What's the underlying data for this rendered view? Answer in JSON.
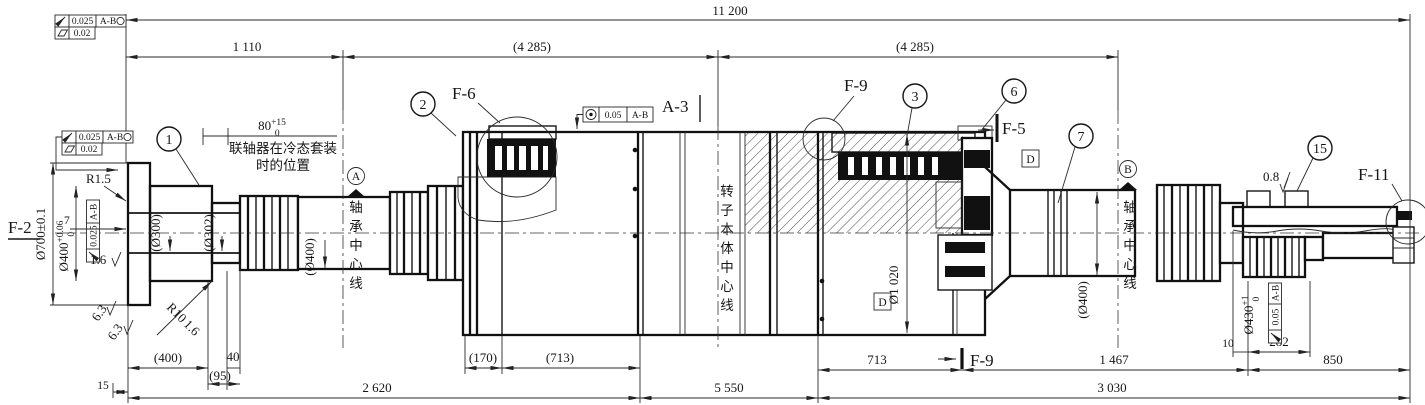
{
  "labels": {
    "f2": "F-2",
    "f6": "F-6",
    "f9_top": "F-9",
    "f9_bot": "F-9",
    "f5": "F-5",
    "f11": "F-11",
    "a3": "A-3"
  },
  "balloons": {
    "b1": "1",
    "b2": "2",
    "b3": "3",
    "b6": "6",
    "b7": "7",
    "b15": "15"
  },
  "datums": {
    "a": "A",
    "b": "B",
    "d": "D"
  },
  "dims": {
    "overall": "11 200",
    "span_left": "1 110",
    "span_mid": "(4 285)",
    "span_right": "(4 285)",
    "pos80": "80",
    "pos80_sup": "+15",
    "pos80_sub": "0",
    "d400p": "(400)",
    "d40": "40",
    "d95": "(95)",
    "d15": "15",
    "d170": "(170)",
    "d713p": "(713)",
    "d2620": "2 620",
    "d5550": "5 550",
    "d713": "713",
    "d1467": "1 467",
    "d850": "850",
    "d3030": "3 030",
    "d10": "10",
    "d282": "282"
  },
  "dia": {
    "d700": "Ø700±0.1",
    "d400": "Ø400",
    "d400_sup": "+0.06",
    "d400_sub": "0",
    "d300": "(Ø300)",
    "d302": "(Ø302)",
    "d400l": "(Ø400)",
    "d1020": "Ø1 020",
    "d400r": "(Ø400)",
    "d430": "Ø430",
    "d430_sup": "+1",
    "d430_sub": "0"
  },
  "surface": {
    "r15": "R1.5",
    "r10": "R10",
    "f16a": "1.6",
    "f16b": "1.6",
    "f63a": "6.3",
    "f63b": "6.3",
    "f08": "0.8",
    "depth7": "7"
  },
  "notes": {
    "coupling1": "联轴器在冷态套装",
    "coupling2": "时的位置",
    "bearing_cl_left": "轴承中心线",
    "rotor_cl": "转子本体中心线",
    "bearing_cl_right": "轴承中心线"
  },
  "tol": {
    "tf1_val": "0.025",
    "tf1_datum": "A-B",
    "tf1b_val": "0.02",
    "tf2_val": "0.025",
    "tf2_datum": "A-B",
    "tf2b_val": "0.02",
    "tf3_val": "0.025",
    "tf3_datum": "A-B",
    "tf4_val": "0.05",
    "tf4_datum": "A-B",
    "tf5_val": "0.05",
    "tf5_datum": "A-B"
  },
  "colors": {
    "ink": "#161616",
    "bg": "#ffffff"
  }
}
